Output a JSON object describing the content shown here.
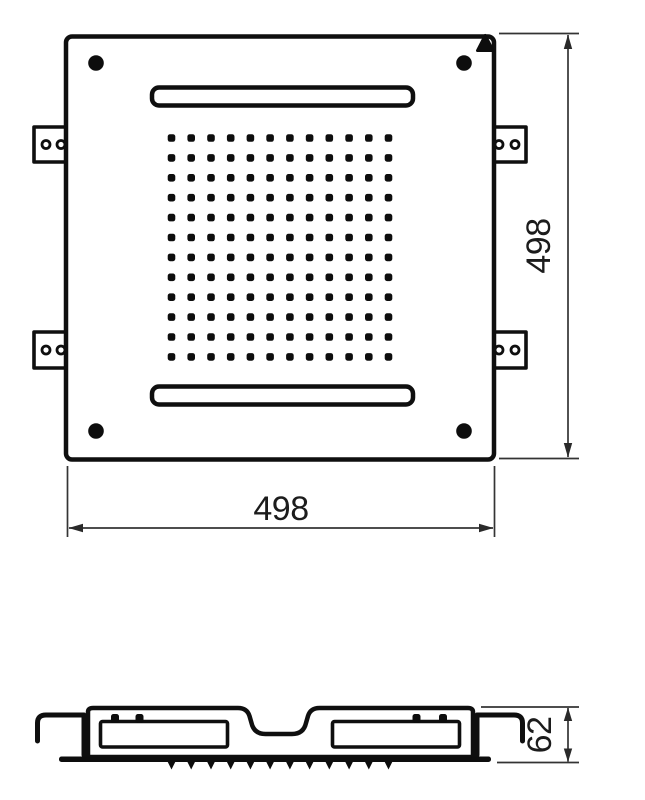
{
  "drawing": {
    "background_color": "#ffffff",
    "line_color": "#0f0f0f",
    "dimension_line_color": "#343434",
    "dimensions": {
      "width_label": "498",
      "height_label": "498",
      "depth_label": "62"
    },
    "top_view": {
      "nozzle_grid": {
        "rows": 12,
        "cols": 12
      },
      "corner_screw_count": 4,
      "mounting_bracket_count": 4,
      "bracket_hole_count_each": 2,
      "slot_count": 2,
      "orientation_marker": "filled-triangle-up"
    },
    "side_view": {
      "spray_teeth_count": 12,
      "chamber_count": 2,
      "chamber_nub_count_each": 2,
      "hook_count": 2
    }
  }
}
